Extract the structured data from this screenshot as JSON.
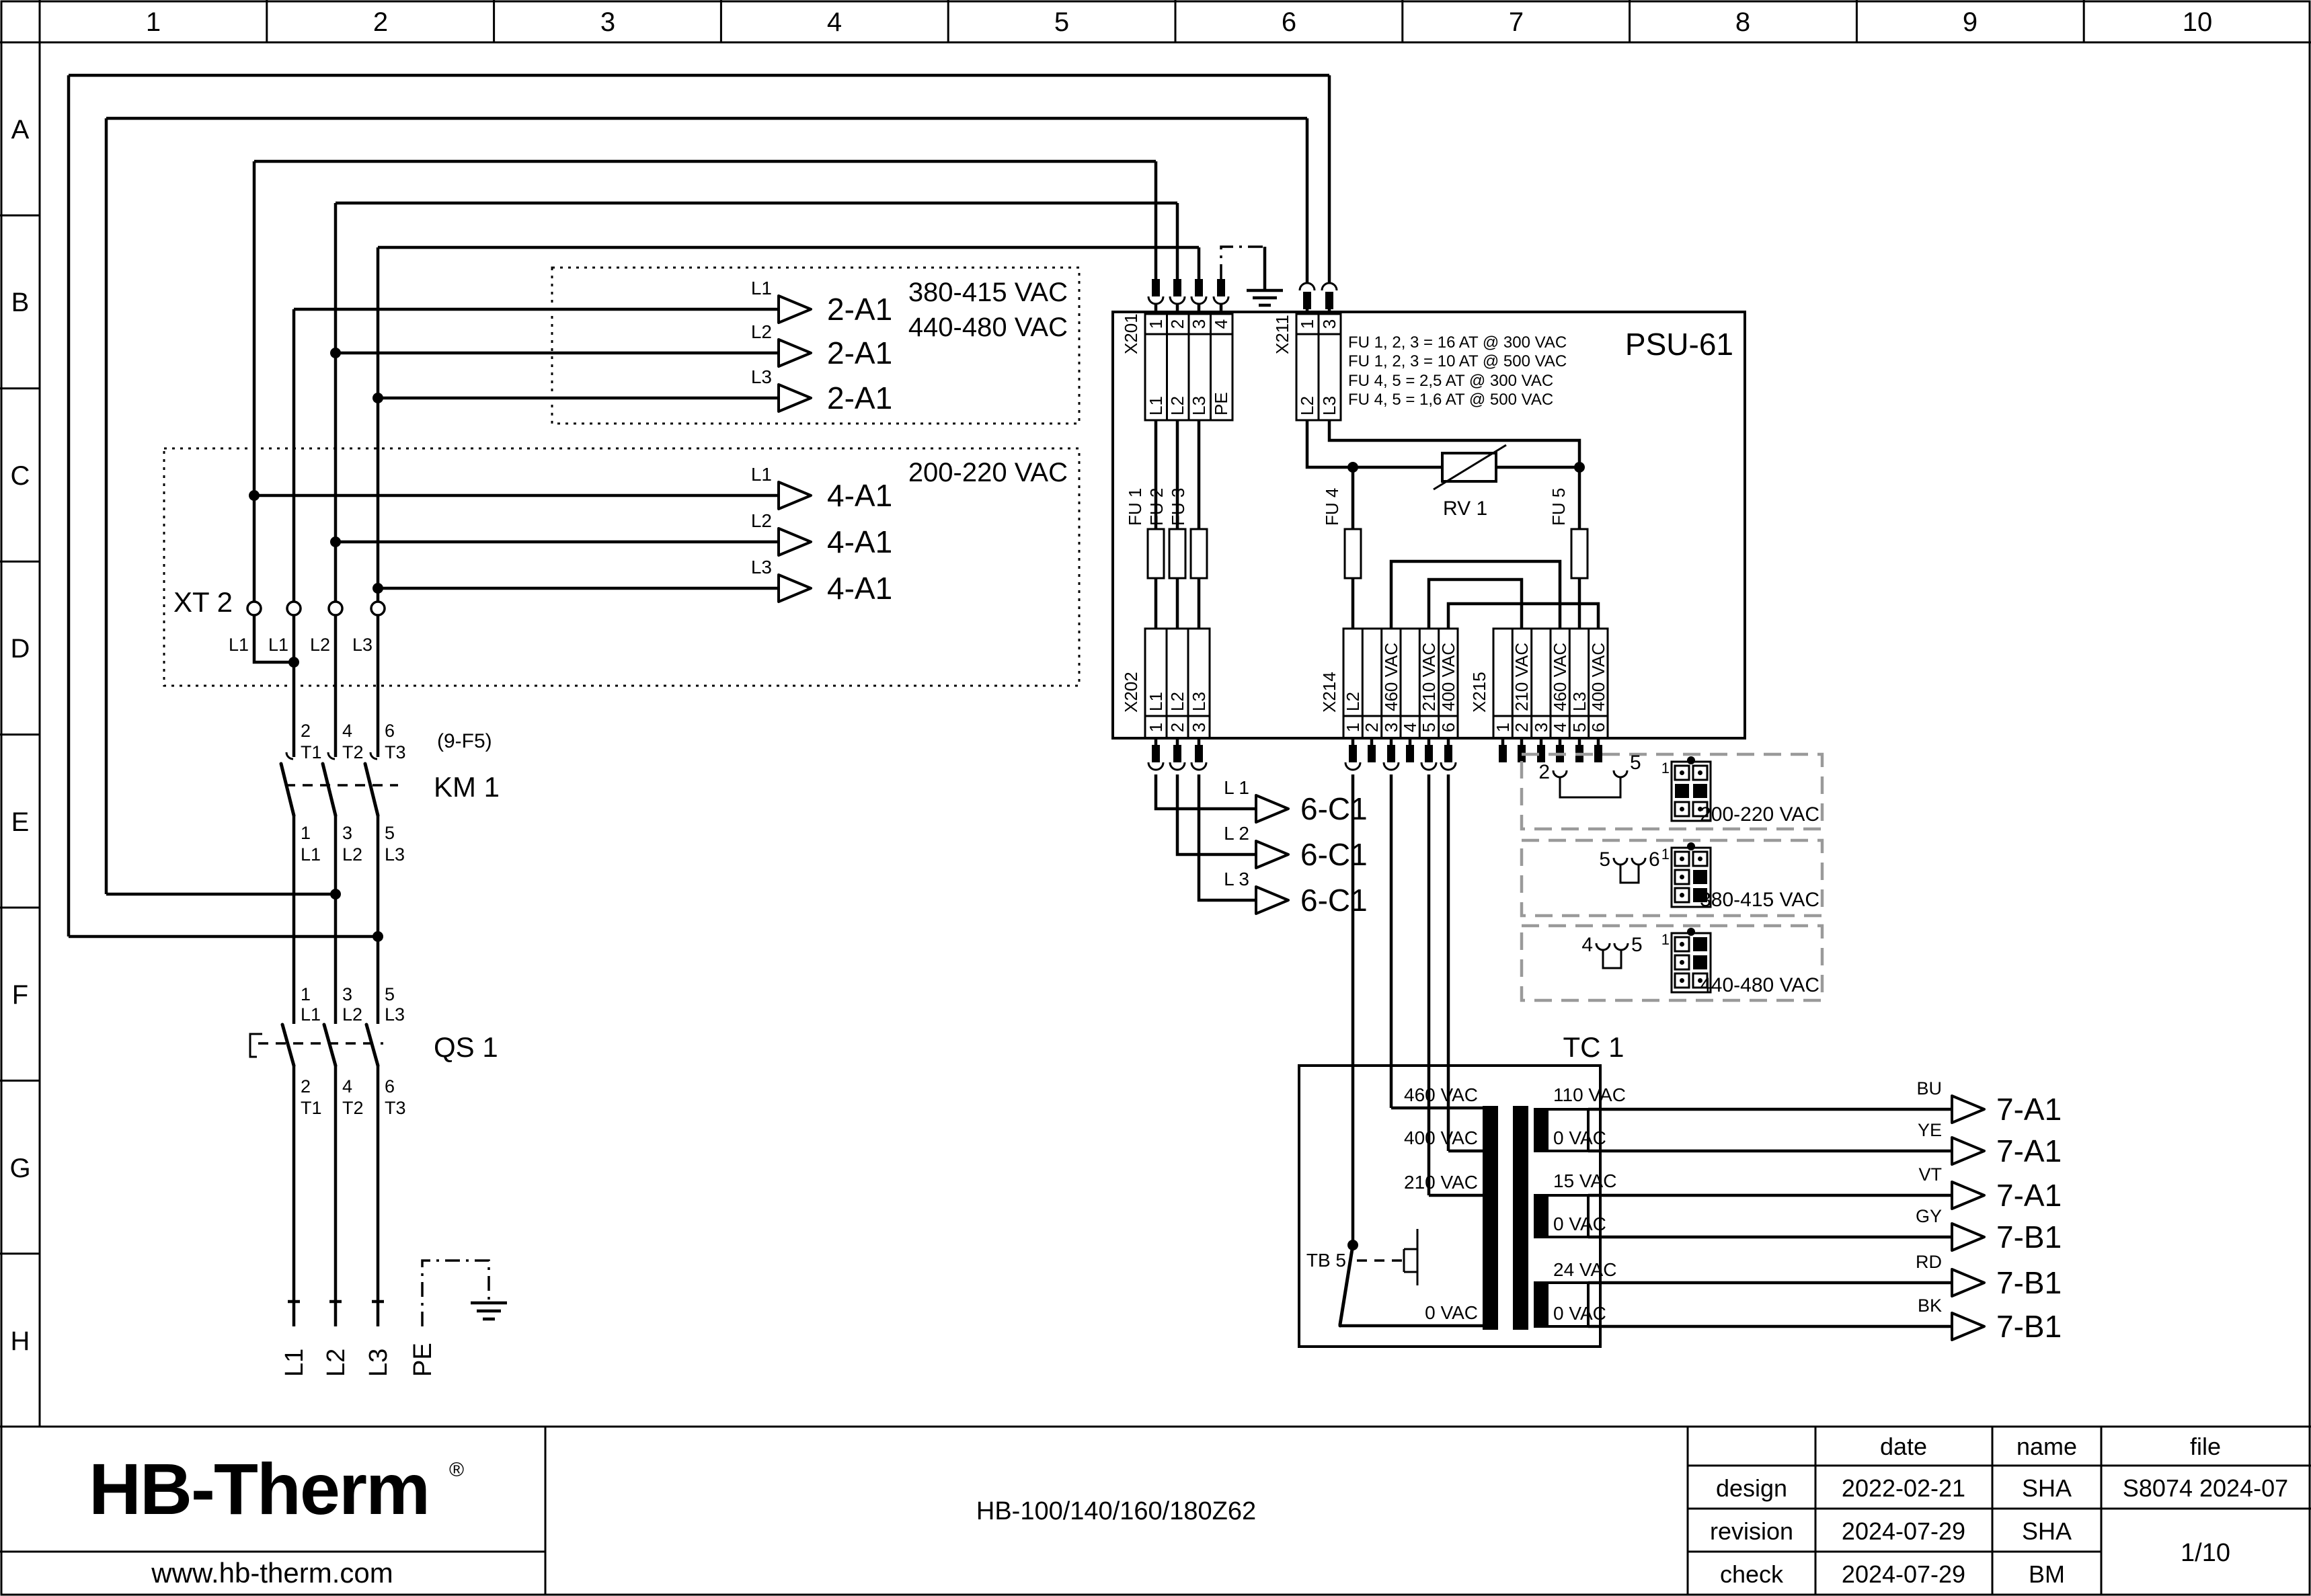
{
  "colors": {
    "navy": "#1b2b4e"
  },
  "grid": {
    "cols": [
      "1",
      "2",
      "3",
      "4",
      "5",
      "6",
      "7",
      "8",
      "9",
      "10"
    ],
    "rows": [
      "A",
      "B",
      "C",
      "D",
      "E",
      "F",
      "G",
      "H"
    ]
  },
  "feed2a1": {
    "volt_a": "380-415 VAC",
    "volt_b": "440-480 VAC",
    "target": "2-A1",
    "phases": [
      "L1",
      "L2",
      "L3"
    ]
  },
  "xt2": {
    "label": "XT 2",
    "volt": "200-220 VAC",
    "target": "4-A1",
    "phases": [
      "L1",
      "L2",
      "L3"
    ],
    "terminals": [
      "L1",
      "L1",
      "L2",
      "L3"
    ]
  },
  "km1": {
    "label": "KM 1",
    "ref": "(9-F5)",
    "top_num": [
      "2",
      "4",
      "6"
    ],
    "top_name": [
      "T1",
      "T2",
      "T3"
    ],
    "bot_num": [
      "1",
      "3",
      "5"
    ],
    "bot_name": [
      "L1",
      "L2",
      "L3"
    ]
  },
  "qs1": {
    "label": "QS 1",
    "top_num": [
      "1",
      "3",
      "5"
    ],
    "top_name": [
      "L1",
      "L2",
      "L3"
    ],
    "bot_num": [
      "2",
      "4",
      "6"
    ],
    "bot_name": [
      "T1",
      "T2",
      "T3"
    ]
  },
  "mains": {
    "labels": [
      "L1",
      "L2",
      "L3",
      "PE"
    ]
  },
  "psu": {
    "label": "PSU-61",
    "x201": {
      "label": "X201",
      "nums": [
        "1",
        "2",
        "3",
        "4"
      ],
      "names": [
        "L1",
        "L2",
        "L3",
        "PE"
      ]
    },
    "x211": {
      "label": "X211",
      "nums": [
        "1",
        "3"
      ],
      "names": [
        "L2",
        "L3"
      ]
    },
    "notes": [
      "FU 1, 2, 3 = 16 AT @ 300 VAC",
      "FU 1, 2, 3 = 10 AT @ 500 VAC",
      "FU 4, 5 = 2,5 AT @ 300 VAC",
      "FU 4, 5 = 1,6 AT @ 500 VAC"
    ],
    "fuses": [
      "FU 1",
      "FU 2",
      "FU 3",
      "FU 4",
      "FU 5"
    ],
    "rv1": "RV 1",
    "x202": {
      "label": "X202",
      "nums": [
        "1",
        "2",
        "3"
      ],
      "names": [
        "L1",
        "L2",
        "L3"
      ]
    },
    "x214": {
      "label": "X214",
      "nums": [
        "1",
        "2",
        "3",
        "4",
        "5",
        "6"
      ],
      "names": [
        "L2",
        "",
        "460 VAC",
        "",
        "210 VAC",
        "400 VAC"
      ]
    },
    "x215": {
      "label": "X215",
      "nums": [
        "1",
        "2",
        "3",
        "4",
        "5",
        "6"
      ],
      "names": [
        "",
        "210 VAC",
        "",
        "460 VAC",
        "L3",
        "400 VAC"
      ]
    }
  },
  "c6": {
    "target": "6-C1",
    "phases": [
      "L 1",
      "L 2",
      "L 3"
    ]
  },
  "options": [
    {
      "pin_a": "2",
      "pin_b": "5",
      "first": "1",
      "volt": "200-220 VAC"
    },
    {
      "pin_a": "5",
      "pin_b": "6",
      "first": "1",
      "volt": "380-415 VAC"
    },
    {
      "pin_a": "4",
      "pin_b": "5",
      "first": "1",
      "volt": "440-480 VAC"
    }
  ],
  "tc1": {
    "label": "TC 1",
    "tb5": "TB 5",
    "primary": [
      "460 VAC",
      "400 VAC",
      "210 VAC",
      "0 VAC"
    ],
    "sec_top": [
      "110 VAC",
      "15 VAC",
      "24 VAC"
    ],
    "sec_bot": [
      "0 VAC",
      "0 VAC",
      "0 VAC"
    ]
  },
  "outputs": [
    {
      "color": "BU",
      "target": "7-A1"
    },
    {
      "color": "YE",
      "target": "7-A1"
    },
    {
      "color": "VT",
      "target": "7-A1"
    },
    {
      "color": "GY",
      "target": "7-B1"
    },
    {
      "color": "RD",
      "target": "7-B1"
    },
    {
      "color": "BK",
      "target": "7-B1"
    }
  ],
  "titleblock": {
    "logo": "HB-Therm",
    "reg": "®",
    "url": "www.hb-therm.com",
    "model": "HB-100/140/160/180Z62",
    "h_date": "date",
    "h_name": "name",
    "h_file": "file",
    "r1": "design",
    "r2": "revision",
    "r3": "check",
    "d1": "2022-02-21",
    "d2": "2024-07-29",
    "d3": "2024-07-29",
    "n1": "SHA",
    "n2": "SHA",
    "n3": "BM",
    "file_no": "S8074 2024-07",
    "page": "1/10"
  }
}
